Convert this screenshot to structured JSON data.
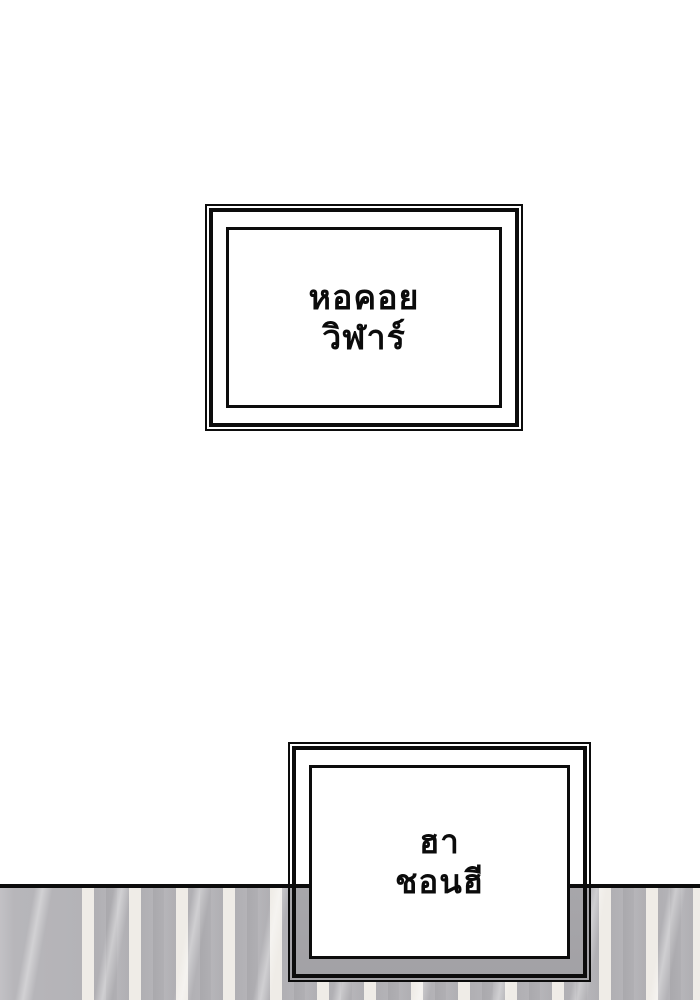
{
  "scene": {
    "type": "comic-panel",
    "background_color": "#ffffff",
    "line_art_color": "#0c0c0c",
    "wall": {
      "stripe_gray": "#b0afb3",
      "stripe_light": "#efece7",
      "left_panel_gray": "#b7b6ba",
      "shadow_gray_behind_sign": "#a7a6aa",
      "floor_line_color": "#0c0c0c"
    }
  },
  "signs": [
    {
      "id": "tower-sign",
      "lines": [
        "หอคอย",
        "วิฬาร์"
      ]
    },
    {
      "id": "name-sign",
      "lines": [
        "ฮา",
        "ชอนฮี"
      ]
    }
  ]
}
